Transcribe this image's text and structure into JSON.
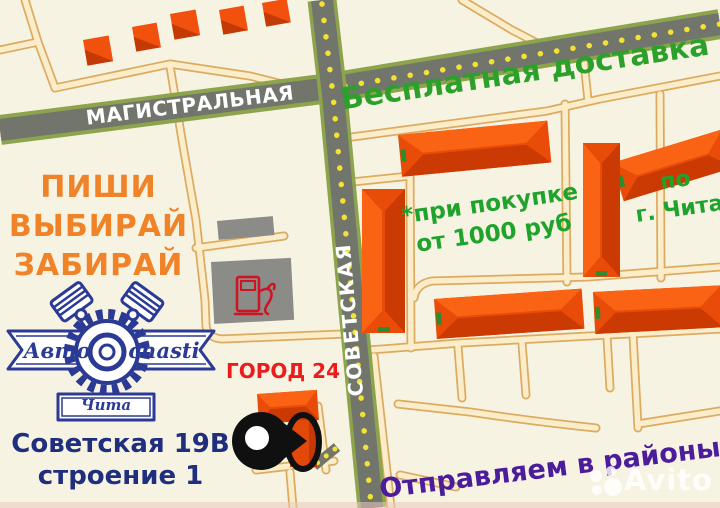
{
  "title": "Avtochasti Chita store location map advertisement",
  "street_labels": {
    "magistralnaya": "МАГИСТРАЛЬНАЯ",
    "sovetskaya": "СОВЕТСКАЯ"
  },
  "promo": {
    "free_delivery": "Бесплатная доставка",
    "condition_line1": "*при покупке",
    "condition_line2": "от 1000 руб",
    "city_line1": "по",
    "city_line2": "г. Чита",
    "slogan_line1": "ПИШИ",
    "slogan_line2": "ВЫБИРАЙ",
    "slogan_line3": "ЗАБИРАЙ",
    "districts": "Отправляем в районы"
  },
  "store": {
    "name": "ГОРОД 24",
    "address_line1": "Советская 19В",
    "address_line2": "строение 1"
  },
  "logo": {
    "left": "Авто",
    "right": "chasti",
    "city": "Чита"
  },
  "watermark": {
    "text": "Avito"
  },
  "icons": {
    "fuel_pump": "fuel-pump-icon",
    "location_pin": "location-pin-icon",
    "logo_gear": "gear-icon",
    "logo_pistons": "piston-icon",
    "avito_dots": "avito-logo-dots",
    "houses": "house-icon"
  },
  "palette": {
    "background": "#f7f3e3",
    "road_asphalt": "#71756c",
    "road_edge_green": "#8ca44c",
    "road_dots_yellow": "#f2e234",
    "minor_road_fill": "#fcedca",
    "minor_road_border": "#dcab62",
    "building_orange": "#f1500d",
    "building_orange_bright": "#fa6214",
    "building_orange_dark": "#cc3a04",
    "building_gray": "#8b8b88",
    "pump_red": "#cf1322",
    "pin_black": "#101010",
    "logo_blue": "#2b3a94",
    "text_green": "#1fa32c",
    "text_orange": "#f08228",
    "text_red": "#ea1c1c",
    "text_navy": "#1f2e7e",
    "text_purple": "#4c1d9b"
  }
}
